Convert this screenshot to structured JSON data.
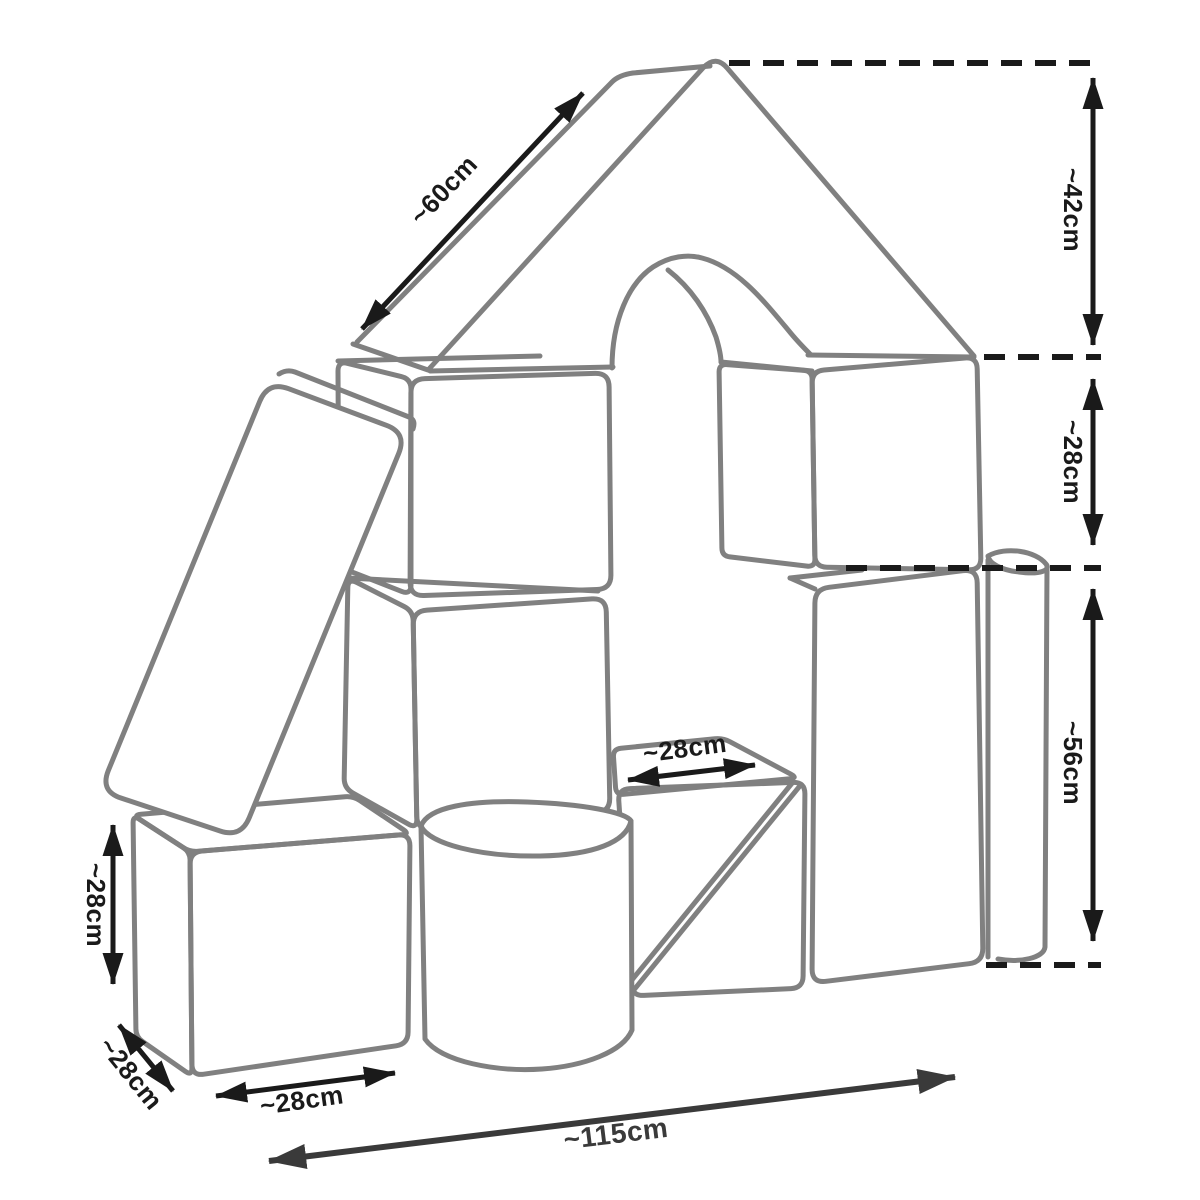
{
  "colors": {
    "background": "#ffffff",
    "block_outline": "#808080",
    "dimension": "#1a1a1a",
    "total_dimension": "#3a3a3a"
  },
  "dimensions": {
    "roof_slope": "~60cm",
    "roof_height": "~42cm",
    "upper_section_height": "~28cm",
    "lower_section_height": "~56cm",
    "step_width": "~28cm",
    "cube_height": "~28cm",
    "cube_depth": "~28cm",
    "cube_width": "~28cm",
    "total_width": "~115cm"
  }
}
